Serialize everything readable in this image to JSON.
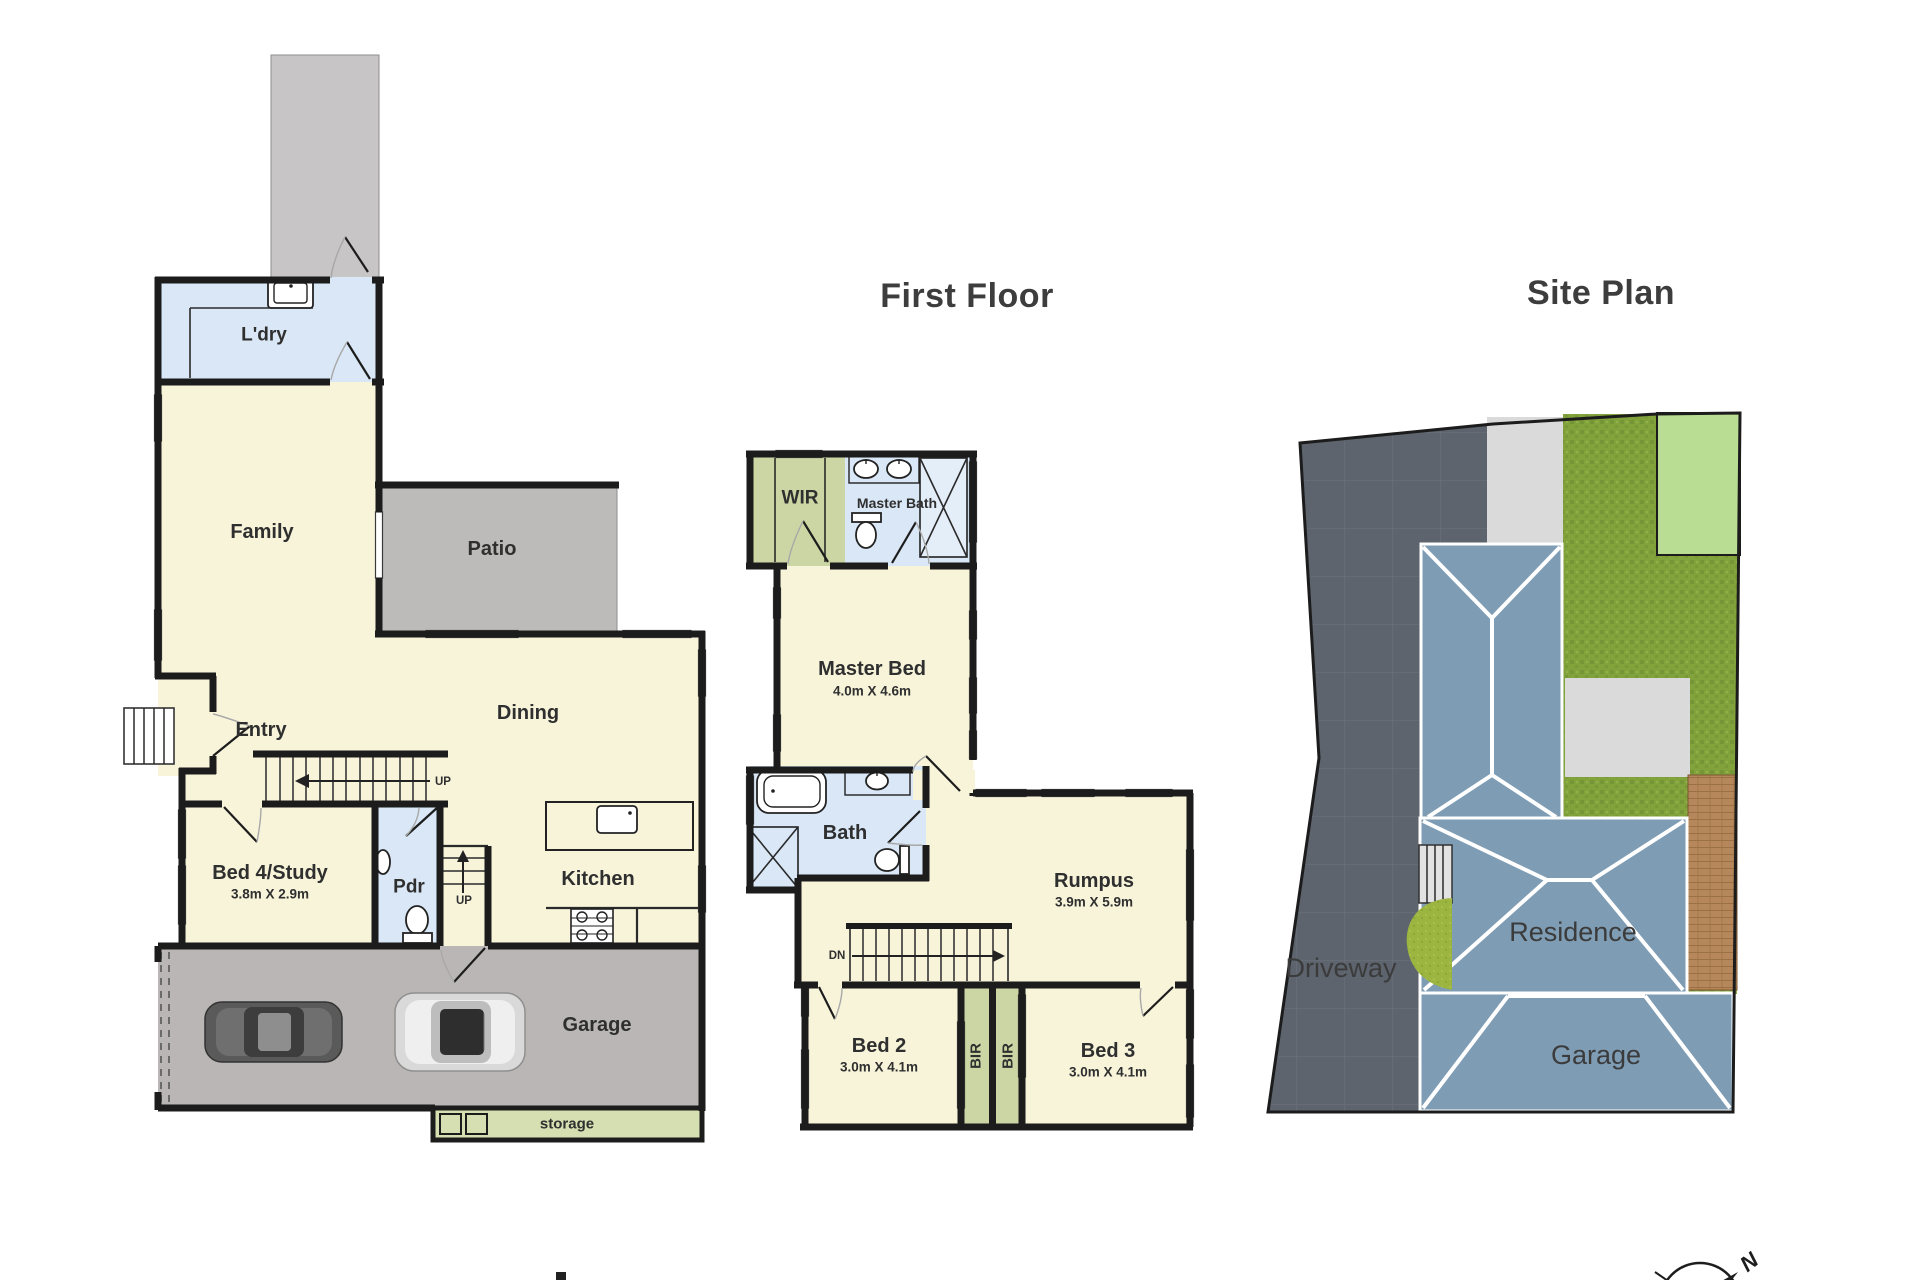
{
  "palette": {
    "wall": "#1c1c1c",
    "label": "#2f2f2f",
    "title": "#3d3d3d",
    "room_cream": "#f7f4da",
    "room_blue": "#d9e7f6",
    "room_blue_light": "#e4eef8",
    "room_green": "#ccd6a4",
    "porch_grey": "#c7c5c5",
    "patio_grey": "#bdbbba",
    "garage_grey": "#b9b6b5",
    "storage_green": "#d6dfb2",
    "site_driveway": "#5d646d",
    "site_path": "#dadada",
    "site_grass": "#82a23c",
    "site_grass_dark": "#6f8f33",
    "site_lawn_light": "#b9dd92",
    "site_lawn_bright": "#9cb440",
    "site_roof": "#7e9cb4",
    "site_deck": "#b5875a",
    "car_dark": "#5a5a5a",
    "car_silver": "#d9d9d9"
  },
  "titles": {
    "first_floor": "First Floor",
    "site_plan": "Site Plan"
  },
  "ground_floor": {
    "rooms": {
      "ldry": {
        "label": "L'dry"
      },
      "family": {
        "label": "Family"
      },
      "patio": {
        "label": "Patio"
      },
      "entry": {
        "label": "Entry"
      },
      "dining": {
        "label": "Dining"
      },
      "bed4": {
        "label": "Bed 4/Study",
        "dims": "3.8m X 2.9m"
      },
      "pdr": {
        "label": "Pdr"
      },
      "kitchen": {
        "label": "Kitchen"
      },
      "garage": {
        "label": "Garage"
      },
      "storage": {
        "label": "storage"
      }
    },
    "stairs": {
      "up1": "UP",
      "up2": "UP"
    }
  },
  "first_floor": {
    "rooms": {
      "wir": {
        "label": "WIR"
      },
      "master_bath": {
        "label": "Master Bath"
      },
      "master_bed": {
        "label": "Master Bed",
        "dims": "4.0m X 4.6m"
      },
      "bath": {
        "label": "Bath"
      },
      "rumpus": {
        "label": "Rumpus",
        "dims": "3.9m X 5.9m"
      },
      "bed2": {
        "label": "Bed 2",
        "dims": "3.0m X 4.1m"
      },
      "bir_left": {
        "label": "BIR"
      },
      "bir_right": {
        "label": "BIR"
      },
      "bed3": {
        "label": "Bed 3",
        "dims": "3.0m X 4.1m"
      }
    },
    "stairs": {
      "dn": "DN"
    }
  },
  "site_plan": {
    "labels": {
      "driveway": "Driveway",
      "residence": "Residence",
      "garage": "Garage"
    },
    "compass_n": "N"
  }
}
